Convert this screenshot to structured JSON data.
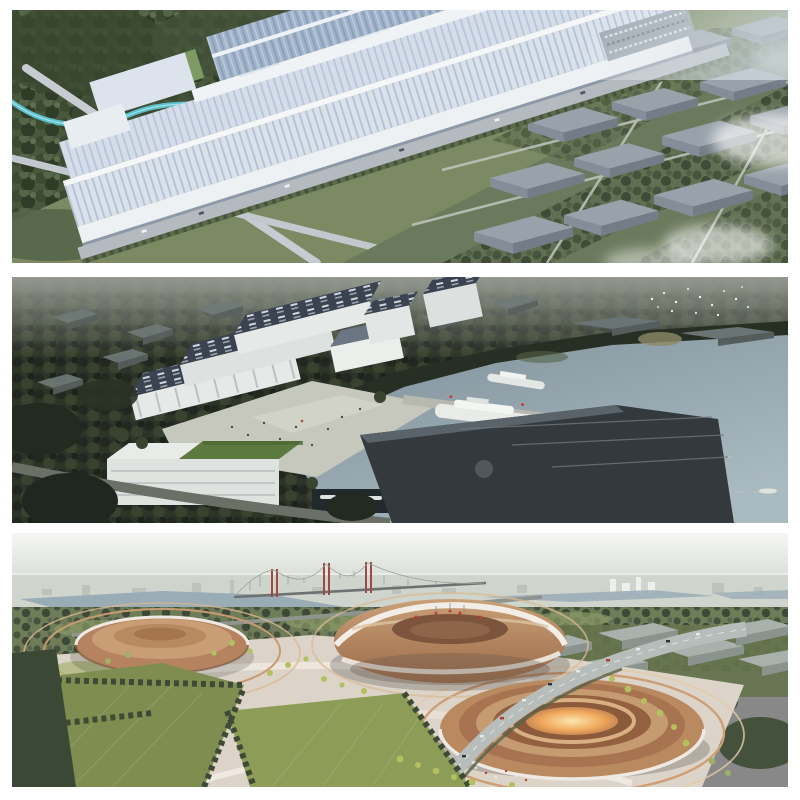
{
  "page": {
    "background": "#ffffff",
    "layout": "three stacked aerial architectural renderings separated by white gaps"
  },
  "panels": [
    {
      "id": "factory-aerial",
      "alt": "Aerial rendering of a long white factory complex with ribbed rooftops running diagonally, dark green forest and a winding teal river at upper left, crossing gray roads, and a grid of gray warehouse blocks among trees with white mist at the right",
      "position": "top"
    },
    {
      "id": "waterfront-campus",
      "alt": "Dusk aerial rendering of a waterfront campus: white halls with dark skylight roofs and a bright plaza at center-left, a pier with white boats, a dark sloped-roof exhibition hall, a white building with a green roof at lower left, and a wide gray-blue lake with small boats to the right",
      "position": "middle"
    },
    {
      "id": "arena-complex",
      "alt": "Hazy aerial rendering of a futuristic arena park: three round copper-bronze arenas with white ribbon bands, one with a glowing orange center, surrounded by curved tan terraces, green lawns with tree rows, a highway with cars, and a red-towered suspension bridge on the skyline",
      "position": "bottom"
    }
  ],
  "palette": {
    "panel1": {
      "forest": "#3f4c34",
      "grass": "#7b8a62",
      "river": "#5ec7d4",
      "road": "#c6ccd1",
      "roof_light": "#d9e1eb",
      "roof_stripe": "#b3c1d4",
      "roof_blue": "#9db0c8",
      "wall_white": "#eef1f4",
      "warehouse_gray": "#99a2ab",
      "mist": "#ffffff"
    },
    "panel2": {
      "trees_dark": "#2c3327",
      "haze": "#9aa096",
      "water": "#8e9da7",
      "building_white": "#e6e9e7",
      "roof_navy": "#3a434f",
      "plaza": "#c6c7bd",
      "dark_hall": "#33393d",
      "green_roof": "#5c7a40",
      "boat_white": "#e8ebe8"
    },
    "panel3": {
      "sky": "#f5f6f3",
      "city": "#b6bdb3",
      "lake": "#9aacb6",
      "field": "#6e7d57",
      "bridge_tower": "#9b4b41",
      "copper": "#b5835f",
      "copper_dark": "#9a6a48",
      "glow": "#f4b872",
      "plaza_tan": "#dcd4c9",
      "lawn": "#7f8e50",
      "bright_tree": "#b4c05e"
    }
  }
}
